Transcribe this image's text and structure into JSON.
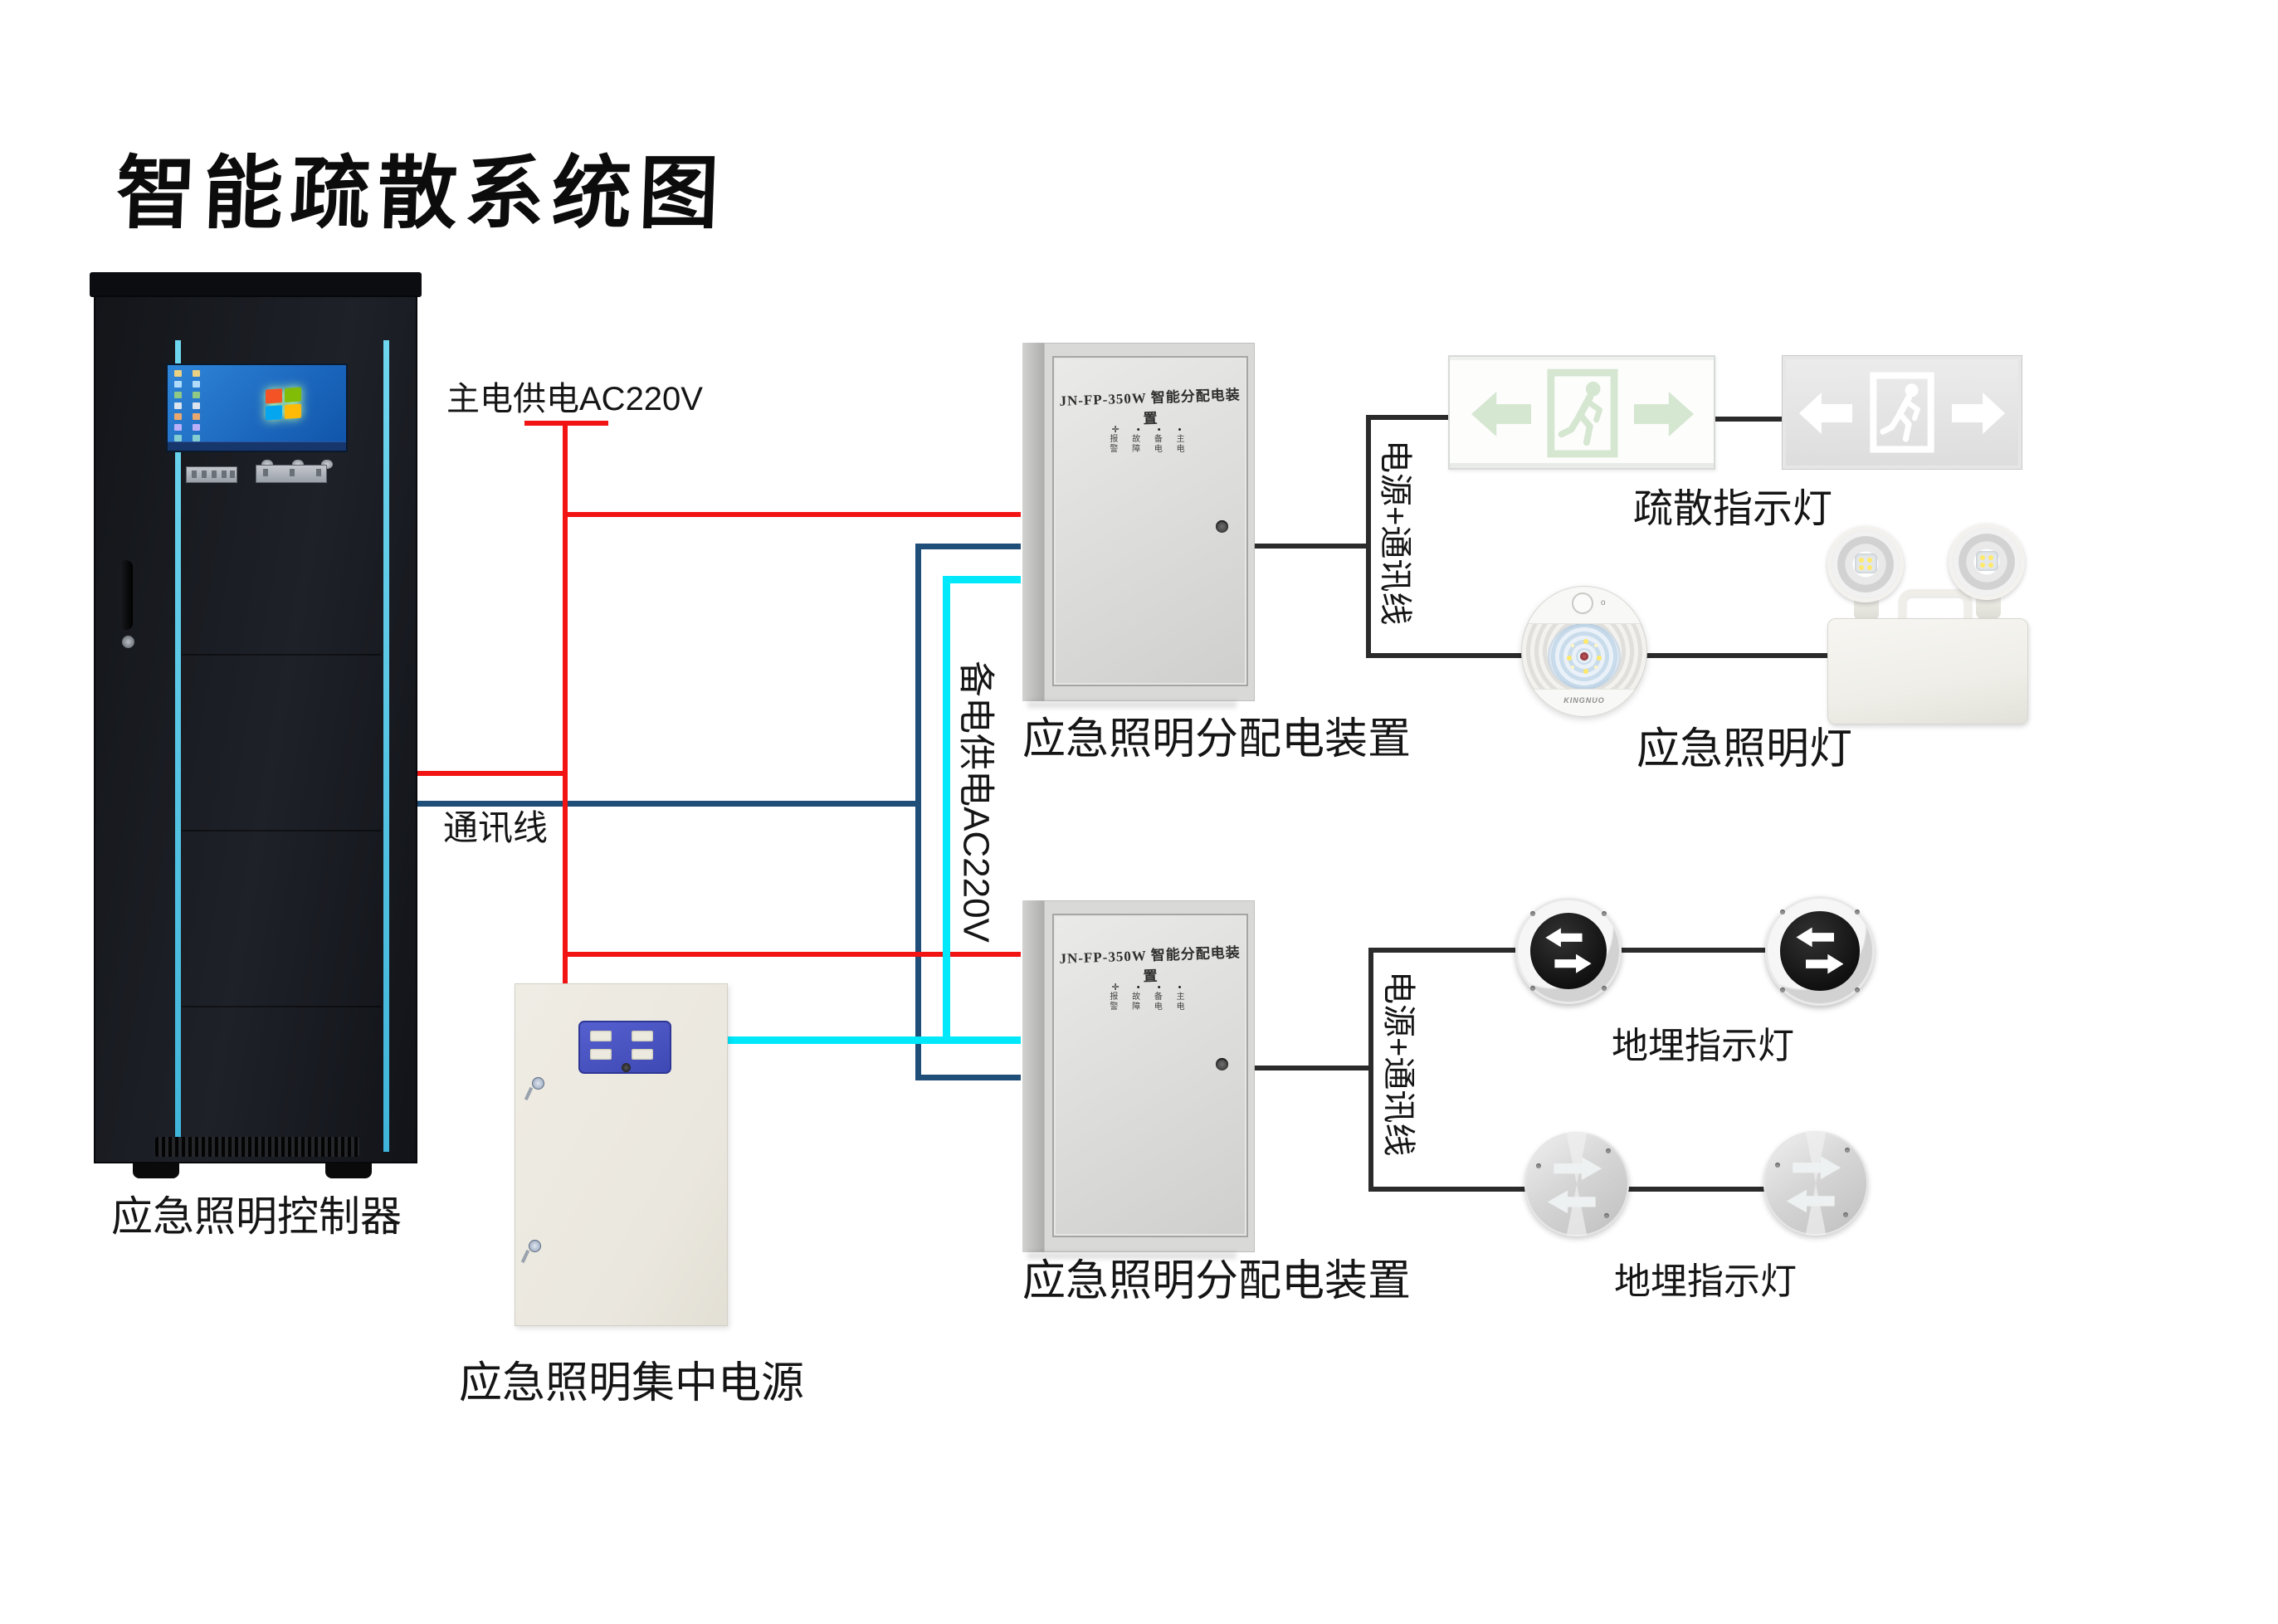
{
  "title": "智能疏散系统图",
  "labels": {
    "controller": "应急照明控制器",
    "main_power": "主电供电AC220V",
    "comm_line": "通讯线",
    "backup_power": "备电供电AC220V",
    "bus1": "电源+通讯线",
    "bus2": "电源+通讯线",
    "box1": "应急照明分配电装置",
    "box2": "应急照明分配电装置",
    "central_power": "应急照明集中电源",
    "exit_sign": "疏散指示灯",
    "emergency_light": "应急照明灯",
    "ground_light1": "地埋指示灯",
    "ground_light2": "地埋指示灯"
  },
  "distribution_box": {
    "door_text": "JN-FP-350W 智能分配电装置",
    "led_dots": "✛ • • •",
    "led_text_row1": "报 故 备 主",
    "led_text_row2": "警 障 电 电"
  },
  "round_lamp": {
    "brand": "KINGNUO"
  },
  "colors": {
    "main_power_line": "#f21313",
    "comm_line": "#1f4e79",
    "backup_power_line": "#00e8fa",
    "connector_line": "#2b2b2b",
    "cabinet_accent": "#55c8ea",
    "panel_blue": "#4752c2"
  }
}
